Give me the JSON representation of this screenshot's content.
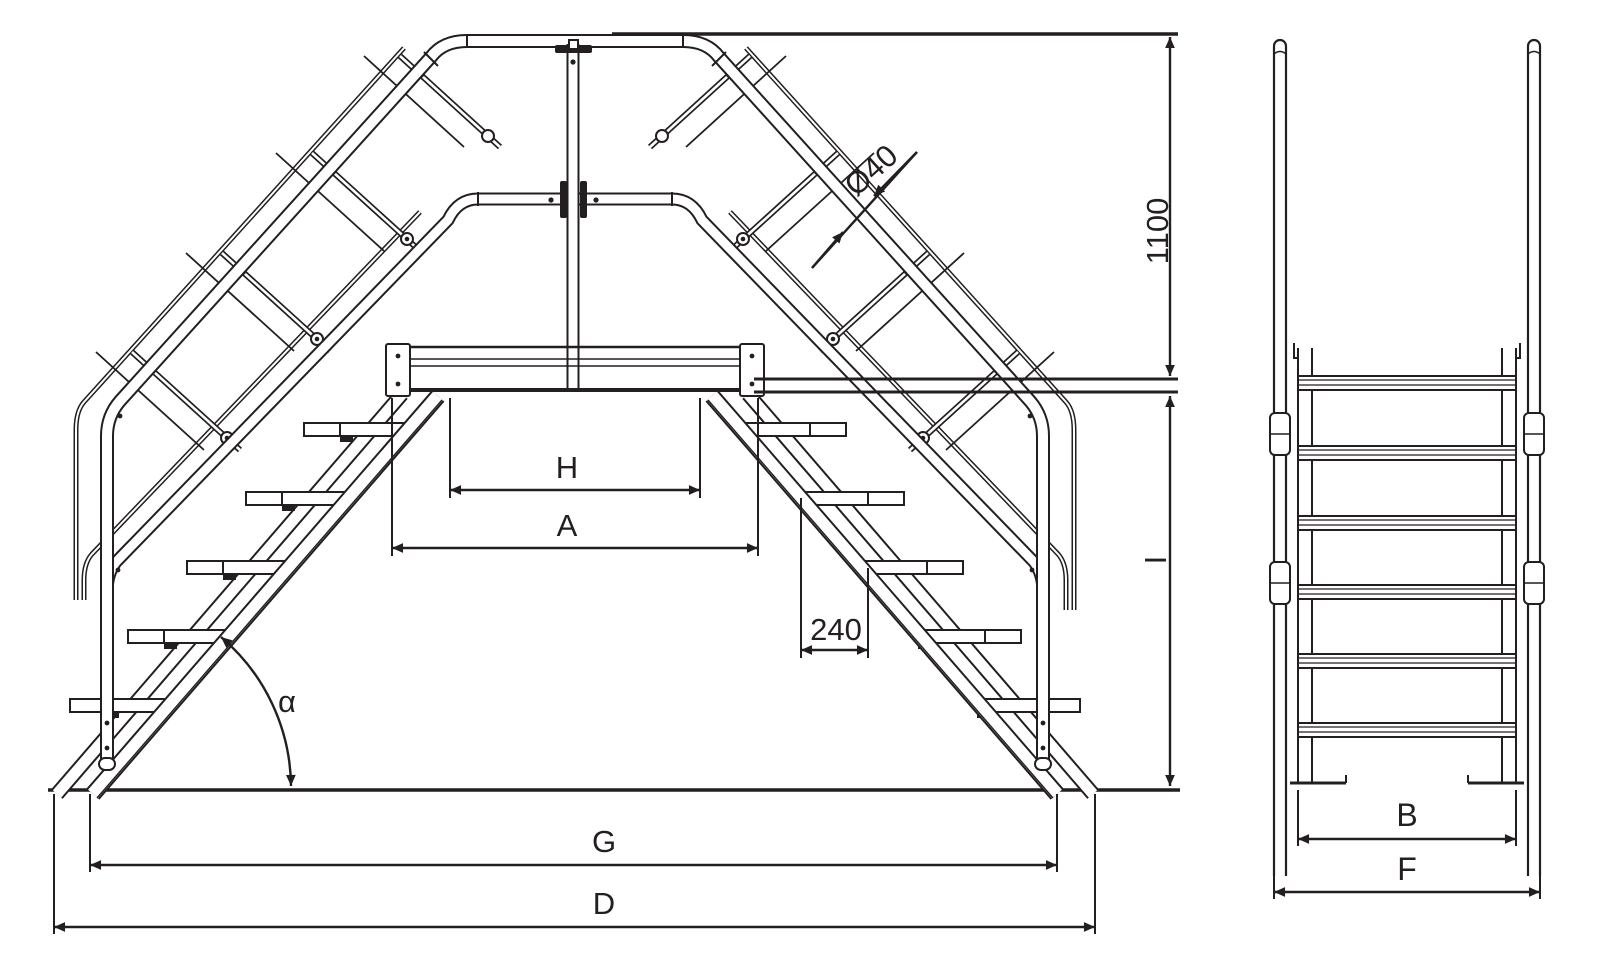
{
  "drawing": {
    "kind": "technical dimension drawing",
    "subject": "crossover stair bridge - front view and side view",
    "line_color": "#231f20",
    "background_color": "#ffffff",
    "labels": {
      "tube_diameter": "Ø40",
      "handrail_height": "1100",
      "clear_width": "H",
      "platform_width": "A",
      "tread_depth": "240",
      "incline_angle": "α",
      "inner_span": "G",
      "overall_span": "D",
      "platform_height": "I",
      "stair_inner_width": "B",
      "stair_overall_width": "F"
    }
  }
}
